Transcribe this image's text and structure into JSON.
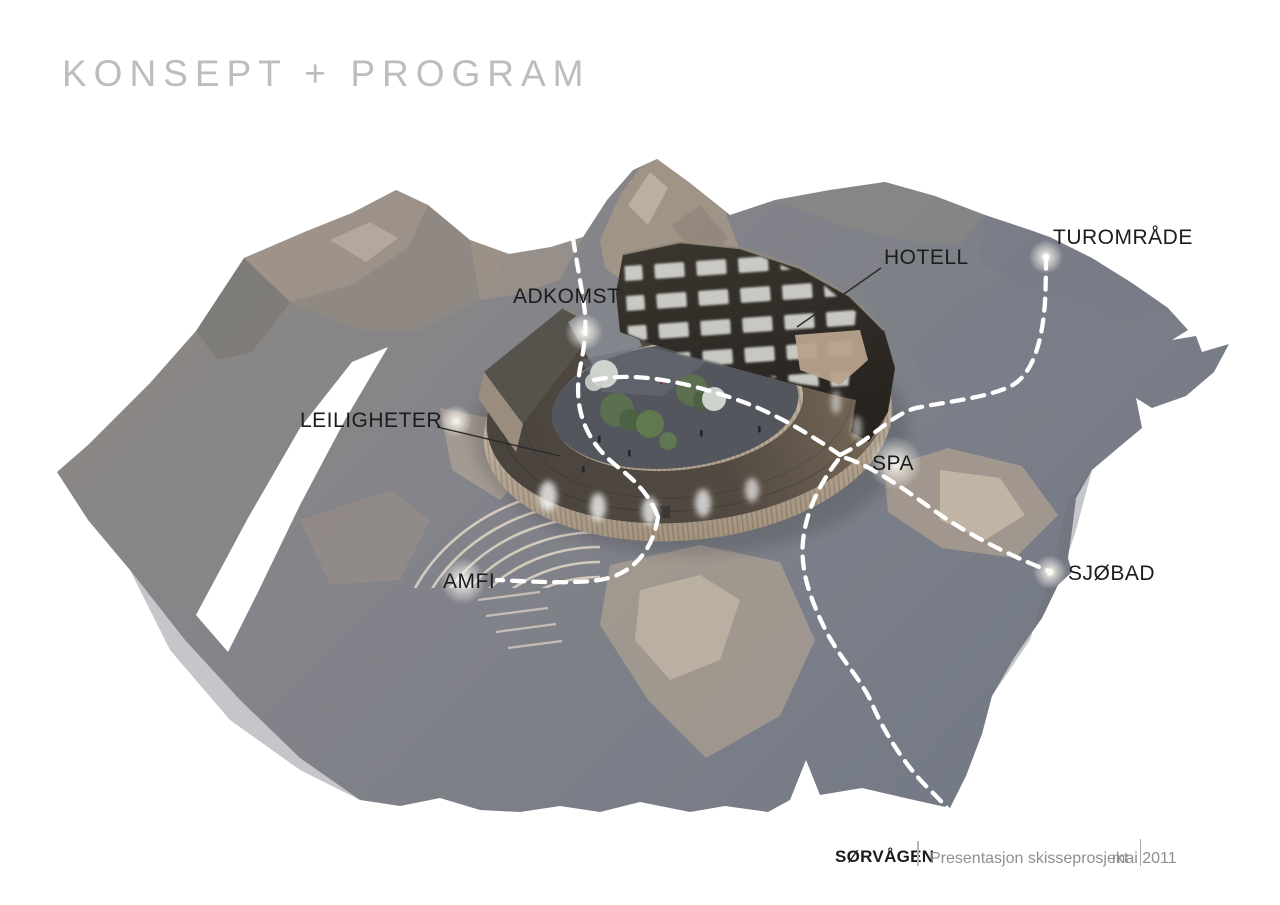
{
  "page": {
    "title": "KONSEPT + PROGRAM"
  },
  "diagram": {
    "description": "3D concept rendering of ring-shaped hotel complex in mountain terrain",
    "labels": [
      {
        "id": "adkomst",
        "text": "ADKOMST"
      },
      {
        "id": "hotell",
        "text": "HOTELL"
      },
      {
        "id": "turomrade",
        "text": "TUROMRÅDE"
      },
      {
        "id": "leiligheter",
        "text": "LEILIGHETER"
      },
      {
        "id": "spa",
        "text": "SPA"
      },
      {
        "id": "amfi",
        "text": "AMFI"
      },
      {
        "id": "sjobad",
        "text": "SJØBAD"
      }
    ]
  },
  "footer": {
    "project": "SØRVÅGEN",
    "separator": "|",
    "subtitle": "Presentasjon skisseprosjekt",
    "date": "mai 2011"
  },
  "colors": {
    "background": "#ffffff",
    "title_gray": "#bdbdbd",
    "label_black": "#1c1c1c",
    "terrain_warm_gray": "#8e8880",
    "terrain_cool_gray": "#767b86",
    "terrain_tan": "#b0a190",
    "roof_dark": "#4e4741",
    "wood_light": "#c9bcaa",
    "hotel_dark": "#302c28",
    "path_white": "#ffffff",
    "footer_gray": "#8f8f8f"
  }
}
